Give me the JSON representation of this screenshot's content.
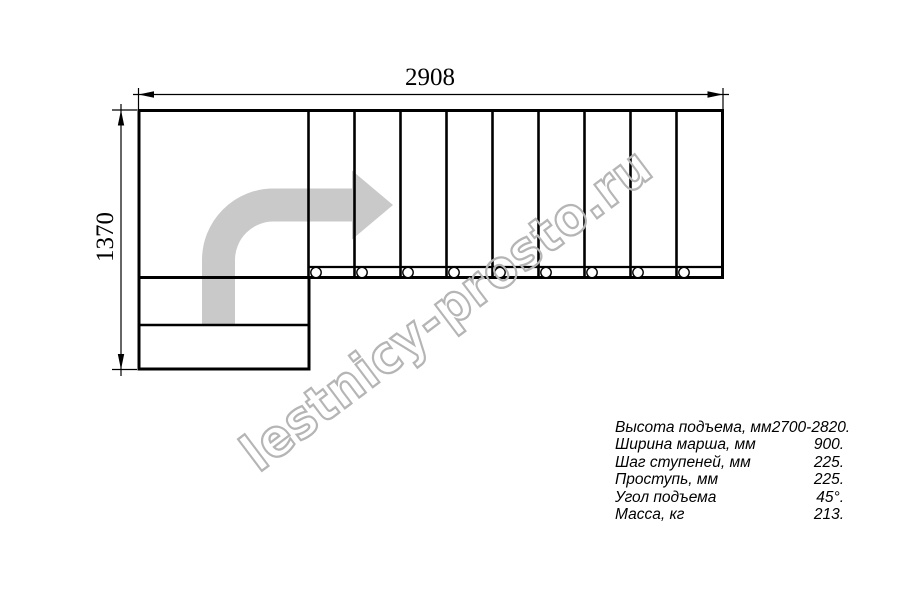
{
  "page": {
    "background_color": "#ffffff",
    "line_color": "#000000"
  },
  "drawing": {
    "title_note": "L-shaped staircase plan view",
    "width_dim": {
      "value": "2908"
    },
    "height_dim": {
      "value": "1370"
    },
    "plan": {
      "main_flight_treads": 9,
      "lower_flight_treads": 2,
      "landing_count": 1,
      "stringer_hole_count": 9
    },
    "icons": {
      "direction_arrow": "curved-arrow-up-then-right",
      "dimension_arrowheads": "filled-triangle-arrows"
    },
    "colors": {
      "arrow_fill": "#c9c9c9",
      "watermark_outline": "#b5b5b5",
      "lines": "#000000"
    }
  },
  "watermark": {
    "text": "lestnicy-prosto.ru"
  },
  "specs": {
    "rows": [
      {
        "label": "Высота подъема, мм",
        "value": "2700-2820."
      },
      {
        "label": "Ширина марша, мм",
        "value": "900."
      },
      {
        "label": "Шаг ступеней, мм",
        "value": "225."
      },
      {
        "label": "Проступь, мм",
        "value": "225."
      },
      {
        "label": "Угол подъема",
        "value": "45°."
      },
      {
        "label": "Масса, кг",
        "value": "213."
      }
    ]
  }
}
